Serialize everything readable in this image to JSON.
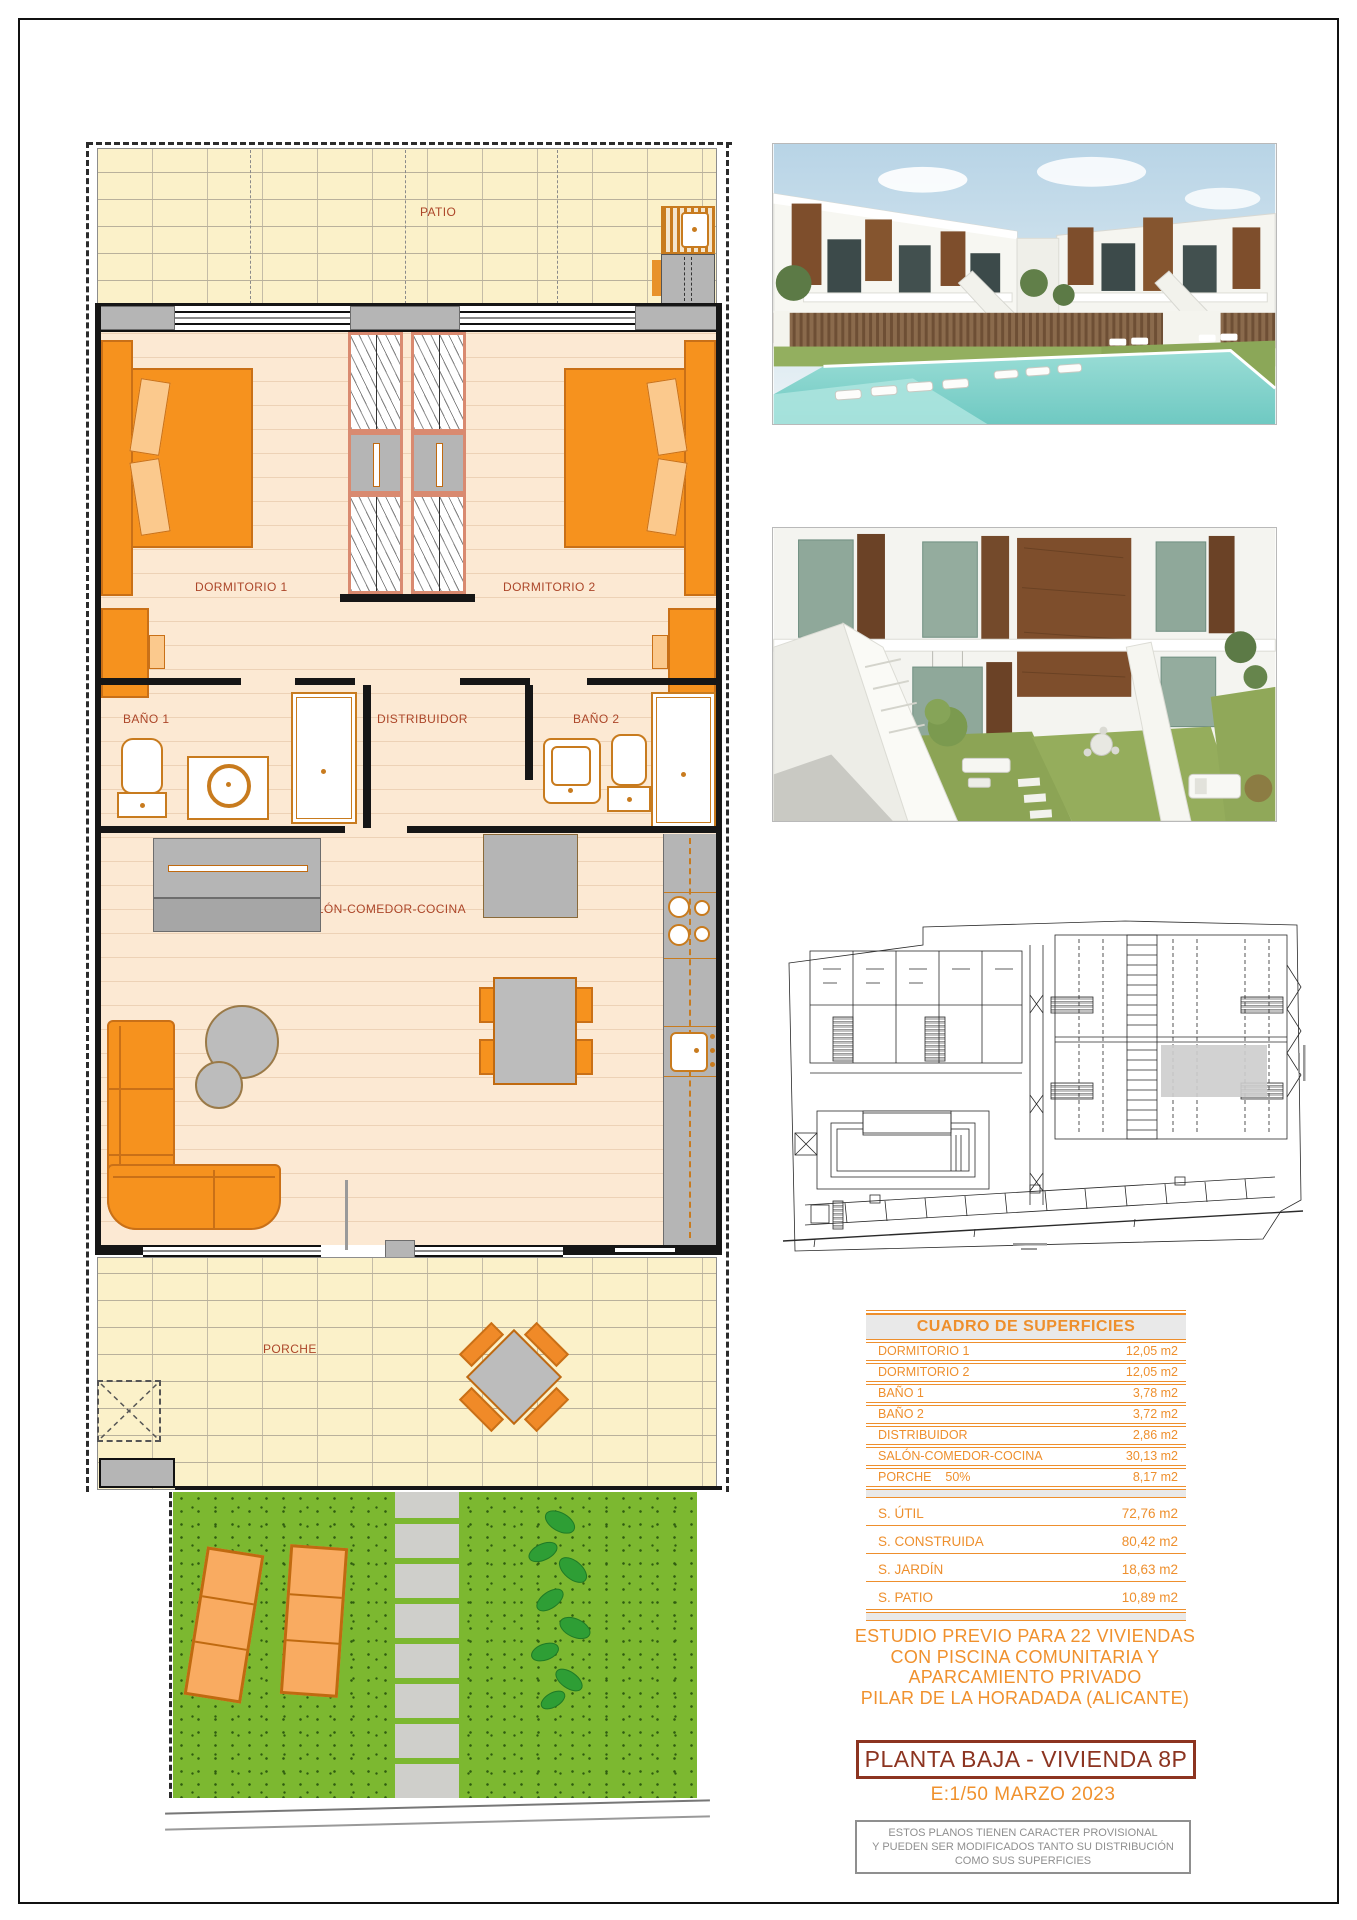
{
  "floor_plan": {
    "rooms": {
      "patio": "PATIO",
      "dorm1": "DORMITORIO 1",
      "dorm2": "DORMITORIO 2",
      "bano1": "BAÑO 1",
      "distribuidor": "DISTRIBUIDOR",
      "bano2": "BAÑO 2",
      "salon": "SALÓN-COMEDOR-COCINA",
      "porche": "PORCHE"
    },
    "label_color": "#AC4629"
  },
  "surfaces_table": {
    "title": "CUADRO DE SUPERFICIES",
    "rows": [
      {
        "label": "DORMITORIO 1",
        "value": "12,05 m2"
      },
      {
        "label": "DORMITORIO 2",
        "value": "12,05 m2"
      },
      {
        "label": "BAÑO 1",
        "value": "3,78 m2"
      },
      {
        "label": "BAÑO 2",
        "value": "3,72 m2"
      },
      {
        "label": "DISTRIBUIDOR",
        "value": "2,86 m2"
      },
      {
        "label": "SALÓN-COMEDOR-COCINA",
        "value": "30,13 m2"
      },
      {
        "label": "PORCHE",
        "note": "50%",
        "value": "8,17 m2"
      }
    ],
    "totals": [
      {
        "label": "S. ÚTIL",
        "value": "72,76 m2"
      },
      {
        "label": "S. CONSTRUIDA",
        "value": "80,42 m2"
      },
      {
        "label": "S. JARDÍN",
        "value": "18,63 m2"
      },
      {
        "label": "S. PATIO",
        "value": "10,89 m2"
      }
    ]
  },
  "project": {
    "description_lines": [
      "ESTUDIO PREVIO PARA 22 VIVIENDAS",
      "CON PISCINA COMUNITARIA Y",
      "APARCAMIENTO PRIVADO",
      "PILAR DE LA HORADADA (ALICANTE)"
    ],
    "plan_title": "PLANTA BAJA - VIVIENDA 8P",
    "scale_date": "E:1/50  MARZO 2023",
    "disclaimer_lines": [
      "ESTOS PLANOS TIENEN CARACTER PROVISIONAL",
      "Y PUEDEN SER MODIFICADOS TANTO SU DISTRIBUCIÓN",
      "COMO SUS SUPERFICIES"
    ]
  },
  "colors": {
    "accent_orange": "#EE8F2D",
    "plan_label": "#AC4629",
    "title_red": "#8C3420",
    "disclaimer_gray": "#8F8F8F",
    "furniture_orange": "#F6921E",
    "garden_green": "#7CB830",
    "pool_teal": "#8ED8D2"
  }
}
